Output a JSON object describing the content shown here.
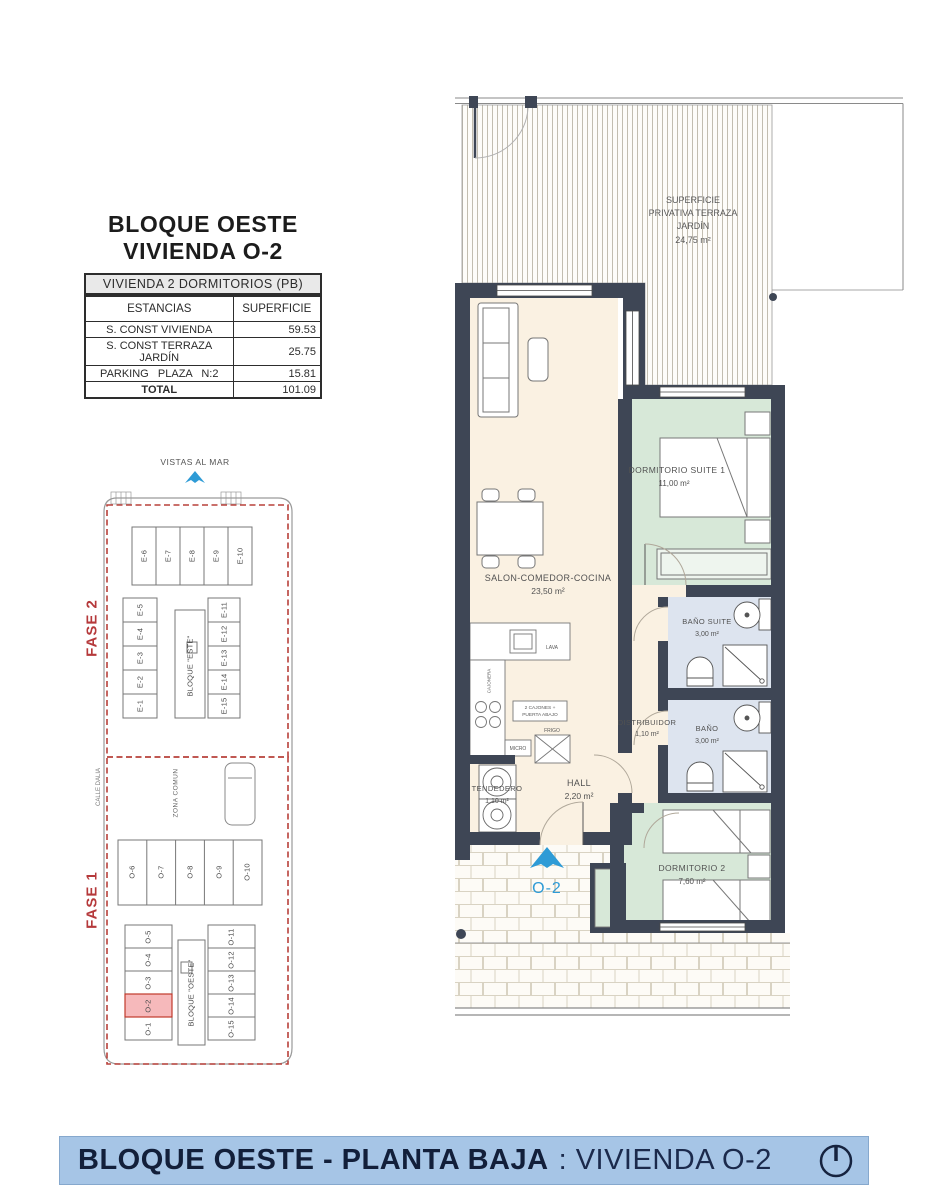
{
  "colors": {
    "wall": "#3e4655",
    "floor_cream": "#faf1e2",
    "room_green": "#d7e8d8",
    "room_blue": "#dde4ef",
    "accent_blue": "#2e9bd6",
    "accent_red": "#b5393b",
    "footer_bg": "#a6c5e6",
    "footer_text": "#121f3a"
  },
  "header": {
    "title_line1": "BLOQUE OESTE",
    "title_line2": "VIVIENDA O-2"
  },
  "area_table": {
    "caption": "VIVIENDA 2 DORMITORIOS (PB)",
    "columns": [
      "ESTANCIAS",
      "SUPERFICIE"
    ],
    "rows": [
      {
        "estancia": "S. CONST VIVIENDA",
        "superficie": "59.53"
      },
      {
        "estancia": "S. CONST TERRAZA JARDÍN",
        "superficie": "25.75"
      },
      {
        "estancia": "PARKING   PLAZA   N:2",
        "superficie": "15.81"
      },
      {
        "estancia": "TOTAL",
        "superficie": "101.09"
      }
    ]
  },
  "site_plan": {
    "vistas_al_mar": "VISTAS AL MAR",
    "fase2": "FASE 2",
    "fase1": "FASE 1",
    "calle": "CALLE DALIA",
    "zona_comun": "ZONA COMUN",
    "bloque_este": "BLOQUE \"ESTE\"",
    "bloque_oeste": "BLOQUE \"OESTE\"",
    "este_top": [
      "E-6",
      "E-7",
      "E-8",
      "E-9",
      "E-10"
    ],
    "este_left": [
      "E-5",
      "E-4",
      "E-3",
      "E-2",
      "E-1"
    ],
    "este_right": [
      "E-11",
      "E-12",
      "E-13",
      "E-14",
      "E-15"
    ],
    "oeste_mid": [
      "O-6",
      "O-7",
      "O-8",
      "O-9",
      "O-10"
    ],
    "oeste_left": [
      "O-5",
      "O-4",
      "O-3",
      "O-2",
      "O-1"
    ],
    "oeste_right": [
      "O-11",
      "O-12",
      "O-13",
      "O-14",
      "O-15"
    ]
  },
  "floor_plan": {
    "terraza": {
      "line1": "SUPERFICIE",
      "line2": "PRIVATIVA TERRAZA",
      "line3": "JARDÍN",
      "area": "24,75 m²"
    },
    "salon": {
      "name": "SALON-COMEDOR-COCINA",
      "area": "23,50 m²"
    },
    "dormitorio1": {
      "name": "DORMITORIO SUITE 1",
      "area": "11,00 m²"
    },
    "bano_suite": {
      "name": "BAÑO SUITE",
      "area": "3,00 m²"
    },
    "bano": {
      "name": "BAÑO",
      "area": "3,00 m²"
    },
    "distribuidor": {
      "name": "DISTRIBUIDOR",
      "area": "1,10 m²"
    },
    "hall": {
      "name": "HALL",
      "area": "2,20 m²"
    },
    "tendedero": {
      "name": "TENDEDERO",
      "area": "1,10 m²"
    },
    "dormitorio2": {
      "name": "DORMITORIO 2",
      "area": "7,60 m²"
    },
    "kitchen_labels": {
      "lava": "LAVA",
      "cajonera": "CAJONERA",
      "cajones_l1": "2 CAJONES +",
      "cajones_l2": "PUERTA ABAJO",
      "frigo": "FRIGO",
      "micro": "MICRO"
    },
    "entrance_unit": "O-2"
  },
  "footer": {
    "title_bold": "BLOQUE OESTE - PLANTA BAJA",
    "title_rest": ": VIVIENDA O-2"
  }
}
